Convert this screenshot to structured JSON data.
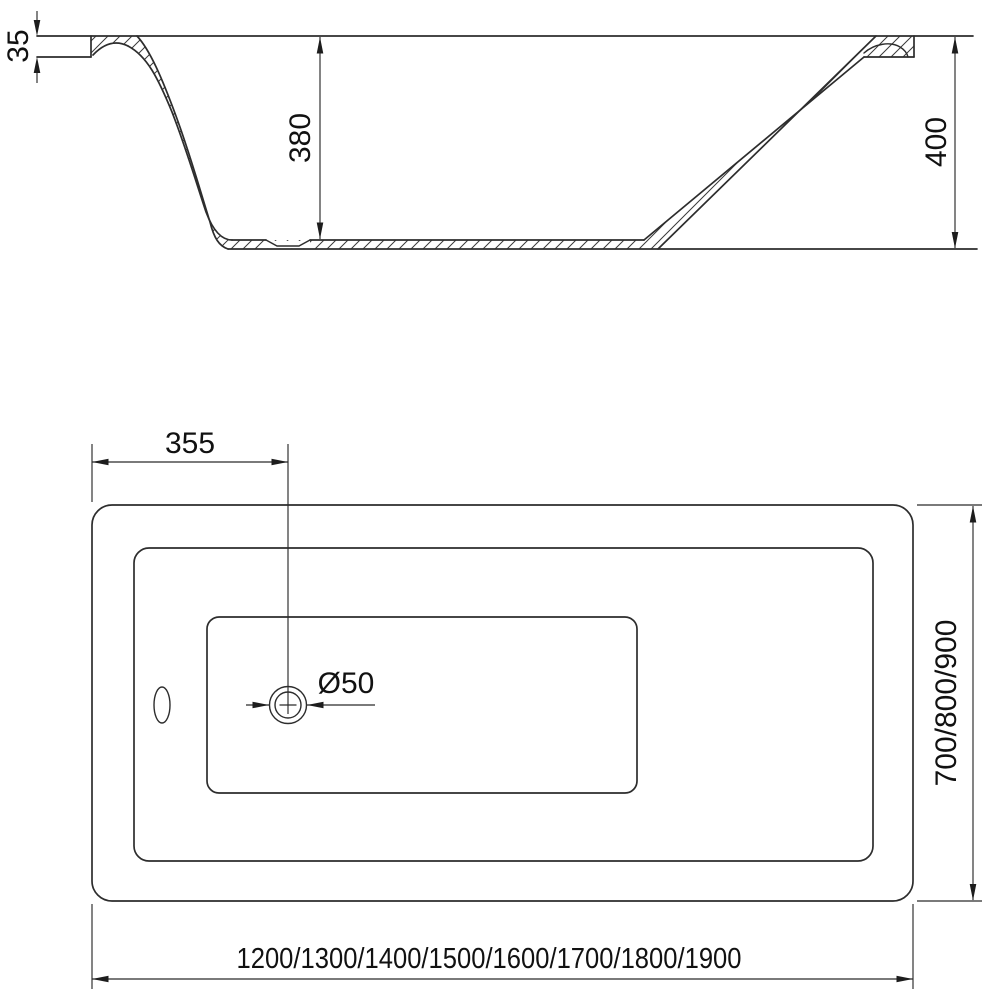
{
  "drawing": {
    "side_view": {
      "flange_thickness": "35",
      "inner_depth": "380",
      "overall_height": "400"
    },
    "plan_view": {
      "drain_offset_from_end": "355",
      "drain_diameter": "Ø50",
      "width_options": "700/800/900",
      "length_options": "1200/1300/1400/1500/1600/1700/1800/1900"
    }
  },
  "colors": {
    "line": "#2d2d2d",
    "dimension_line": "#2a2a2a",
    "text": "#111111",
    "background": "#ffffff"
  }
}
